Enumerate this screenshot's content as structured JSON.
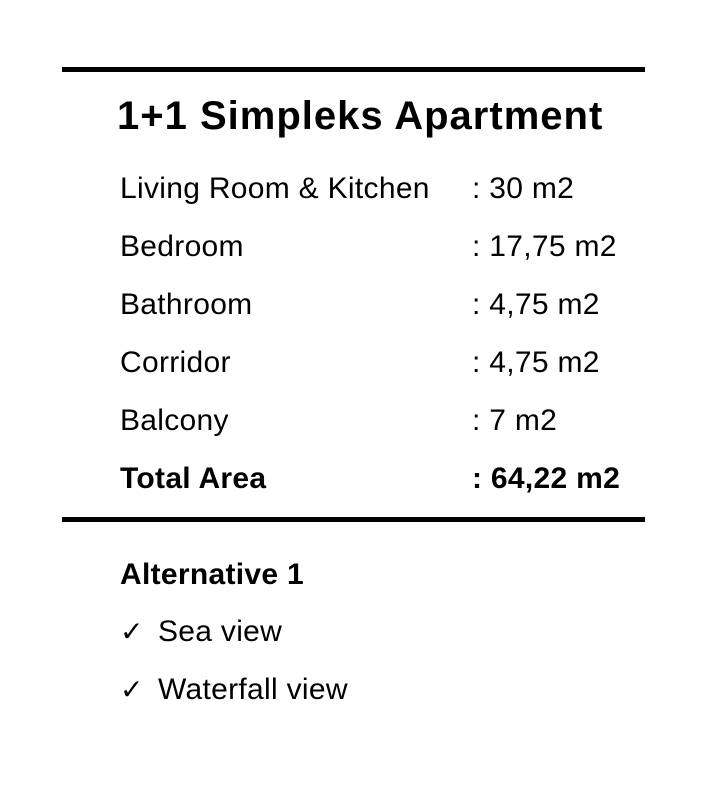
{
  "title": "1+1 Simpleks Apartment",
  "spec_table": {
    "rows": [
      {
        "label": "Living Room & Kitchen",
        "value": ": 30 m2"
      },
      {
        "label": "Bedroom",
        "value": ": 17,75 m2"
      },
      {
        "label": "Bathroom",
        "value": ": 4,75 m2"
      },
      {
        "label": "Corridor",
        "value": ": 4,75 m2"
      },
      {
        "label": "Balcony",
        "value": ": 7 m2"
      },
      {
        "label": "Total Area",
        "value": ": 64,22 m2"
      }
    ]
  },
  "alternative": {
    "heading": "Alternative 1",
    "check_glyph": "✓",
    "items": [
      {
        "label": "Sea view"
      },
      {
        "label": "Waterfall view"
      }
    ]
  },
  "colors": {
    "background": "#ffffff",
    "text": "#000000",
    "rule": "#000000"
  }
}
